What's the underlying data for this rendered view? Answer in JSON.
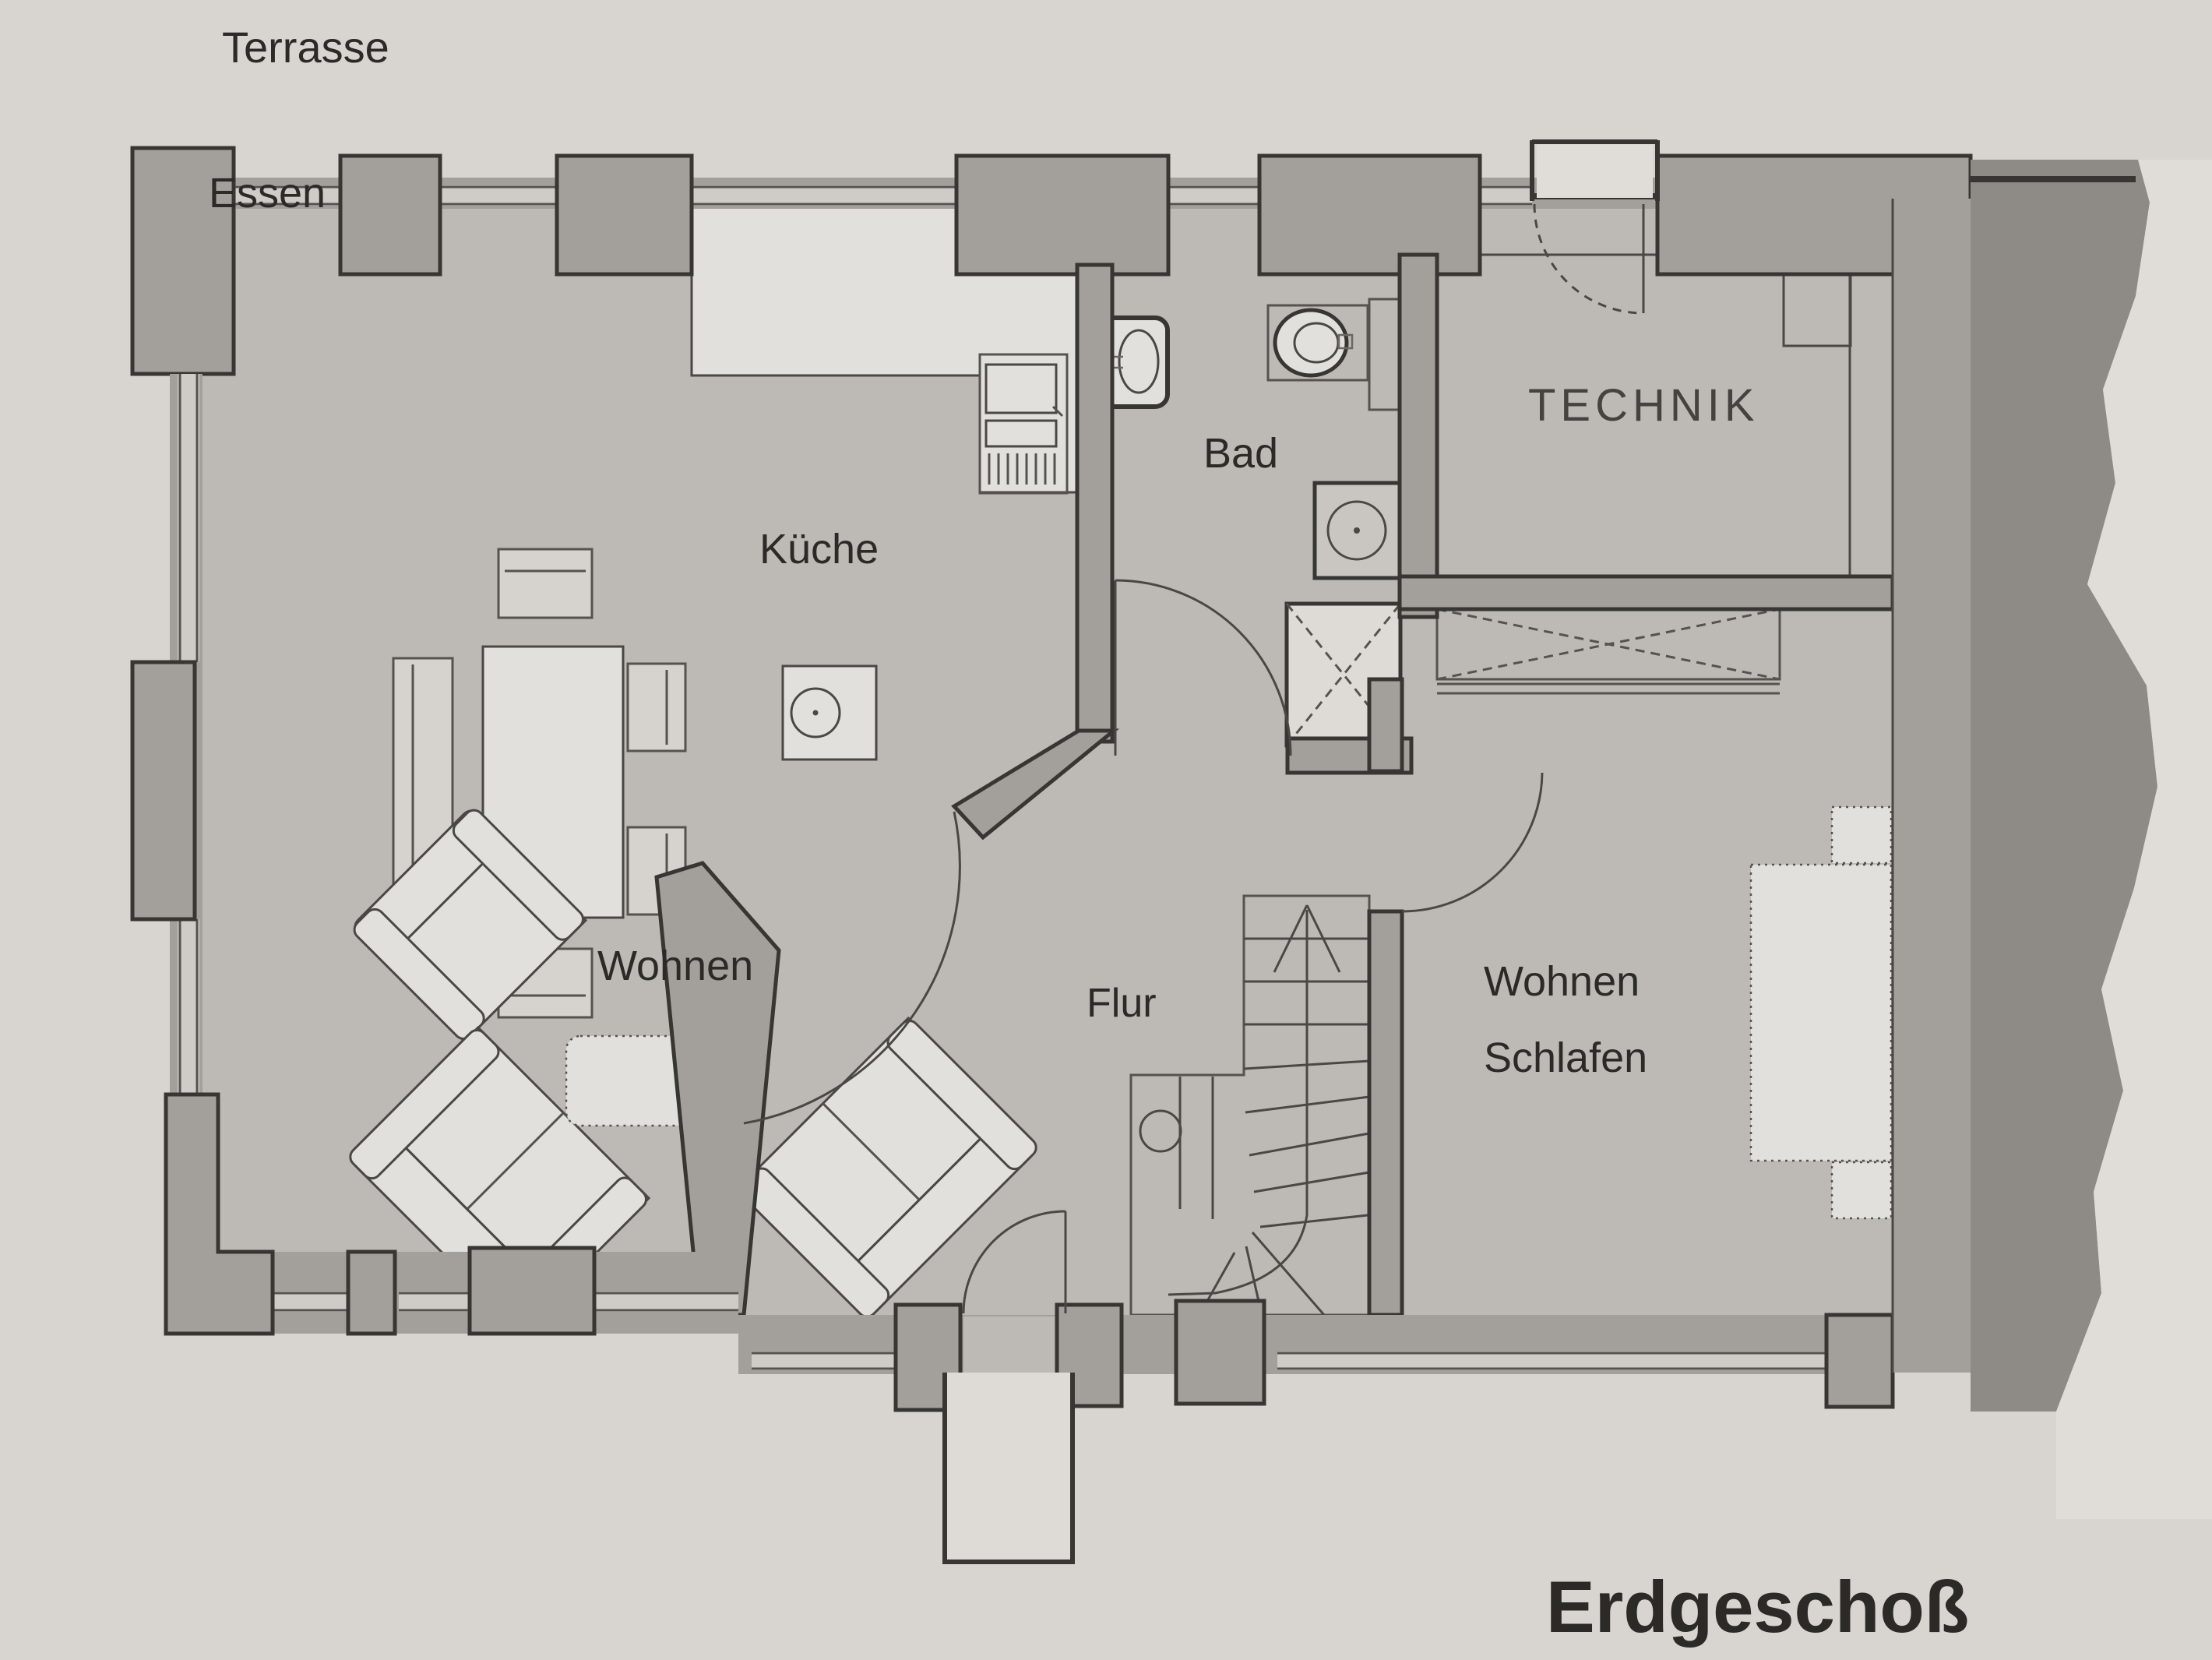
{
  "labels": {
    "terrasse": "Terrasse",
    "essen": "Essen",
    "kueche": "Küche",
    "bad": "Bad",
    "technik": "TECHNIK",
    "wohnen": "Wohnen",
    "flur": "Flur",
    "wohnen_schlafen": {
      "line1": "Wohnen",
      "line2": "Schlafen"
    },
    "erdgeschoss": "Erdgeschoß"
  },
  "colors": {
    "paper": "#d8d5d0",
    "floor": "#bdbab5",
    "wall_fill": "#a3a09b",
    "wall_outline": "#383632",
    "line": "#4a4845",
    "furniture_fill": "#e2e0dc",
    "window_glass": "#cfccc7",
    "torn_shadow": "#8e8b86",
    "text": "#2b2a27"
  }
}
